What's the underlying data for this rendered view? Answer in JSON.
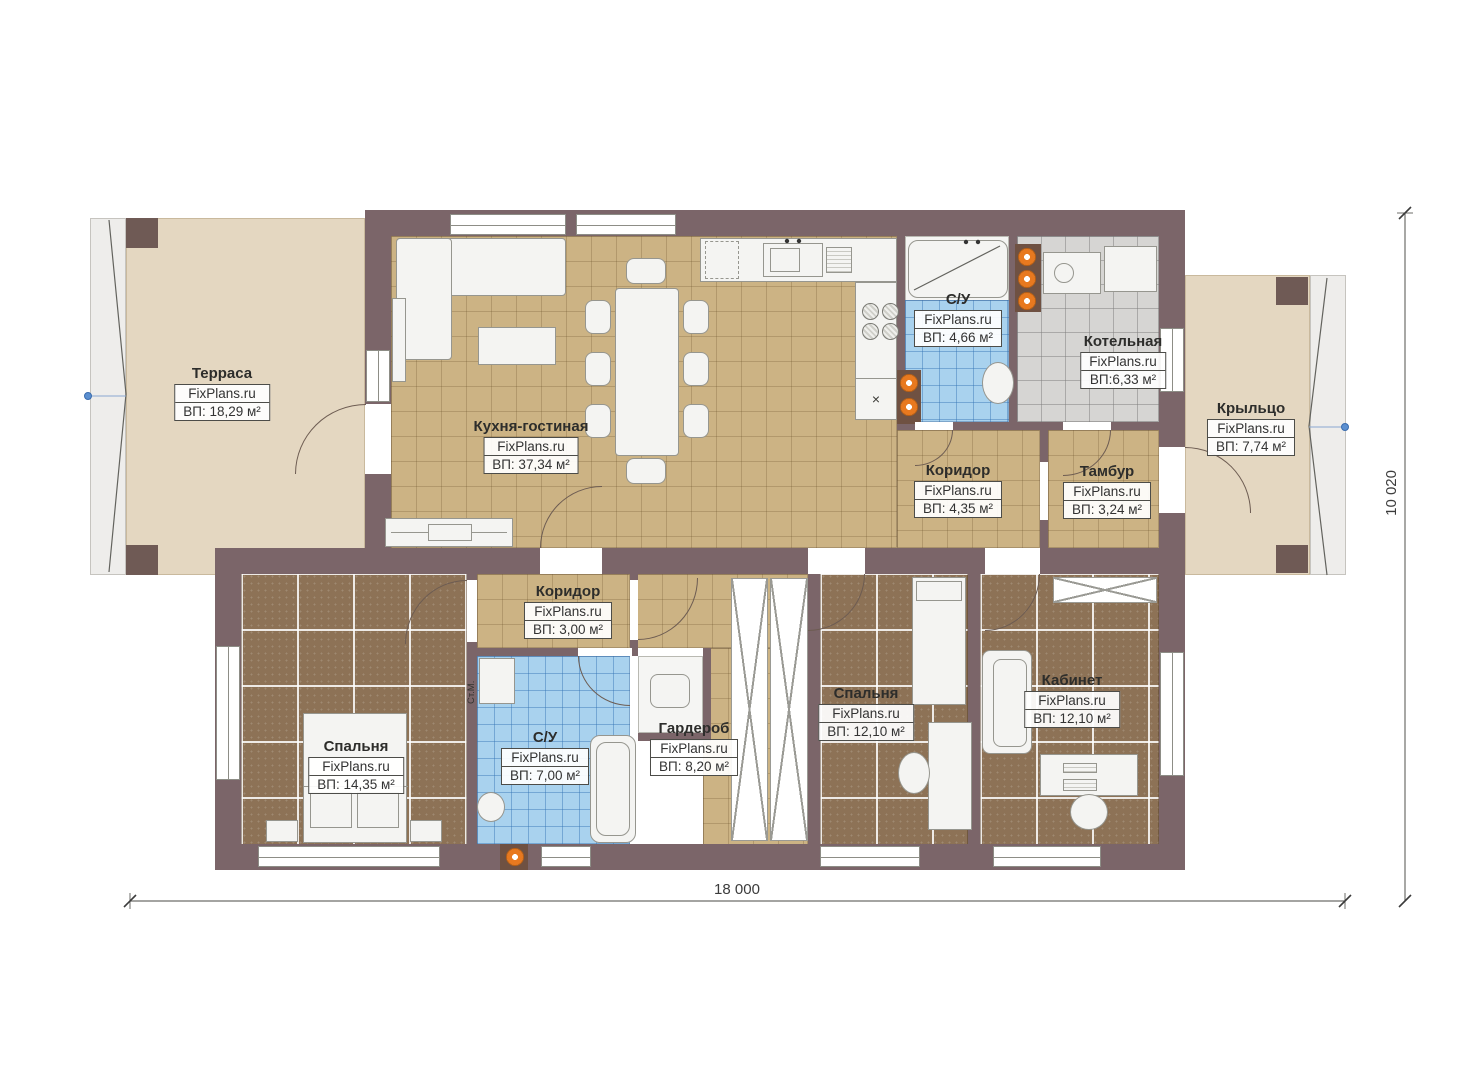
{
  "watermark": "FixPlans.ru",
  "rooms": [
    {
      "key": "terrace",
      "name": "Терраса",
      "brand": "FixPlans.ru",
      "area": "ВП: 18,29 м²"
    },
    {
      "key": "kitchen-living",
      "name": "Кухня-гостиная",
      "brand": "FixPlans.ru",
      "area": "ВП: 37,34 м²"
    },
    {
      "key": "bathroom-upper",
      "name": "С/У",
      "brand": "FixPlans.ru",
      "area": "ВП: 4,66 м²"
    },
    {
      "key": "boiler-room",
      "name": "Котельная",
      "brand": "FixPlans.ru",
      "area": "ВП:6,33 м²"
    },
    {
      "key": "porch",
      "name": "Крыльцо",
      "brand": "FixPlans.ru",
      "area": "ВП: 7,74 м²"
    },
    {
      "key": "corridor-upper",
      "name": "Коридор",
      "brand": "FixPlans.ru",
      "area": "ВП: 4,35 м²"
    },
    {
      "key": "vestibule",
      "name": "Тамбур",
      "brand": "FixPlans.ru",
      "area": "ВП: 3,24 м²"
    },
    {
      "key": "corridor-lower",
      "name": "Коридор",
      "brand": "FixPlans.ru",
      "area": "ВП: 3,00 м²"
    },
    {
      "key": "bedroom-1",
      "name": "Спальня",
      "brand": "FixPlans.ru",
      "area": "ВП: 14,35 м²"
    },
    {
      "key": "bathroom-lower",
      "name": "С/У",
      "brand": "FixPlans.ru",
      "area": "ВП: 7,00 м²"
    },
    {
      "key": "wardrobe",
      "name": "Гардероб",
      "brand": "FixPlans.ru",
      "area": "ВП: 8,20 м²"
    },
    {
      "key": "bedroom-2",
      "name": "Спальня",
      "brand": "FixPlans.ru",
      "area": "ВП: 12,10 м²"
    },
    {
      "key": "office",
      "name": "Кабинет",
      "brand": "FixPlans.ru",
      "area": "ВП: 12,10 м²"
    }
  ],
  "dimensions": {
    "width_label": "18 000",
    "height_label": "10 020"
  },
  "annotations": {
    "washing_machine": "Ст.М.",
    "kitchen_mark": "×"
  },
  "colors": {
    "wall": "#7b6569",
    "tile_tan": "#ccb384",
    "tile_blue": "#a9d2ee",
    "tile_gray": "#d6d5d3",
    "floor_brown": "#8d7256",
    "terrace_beige": "#e4d7c1",
    "fixture_orange": "#e8791f",
    "furniture": "#f4f4f2",
    "dimension_marker_blue": "#5b8fd0"
  }
}
